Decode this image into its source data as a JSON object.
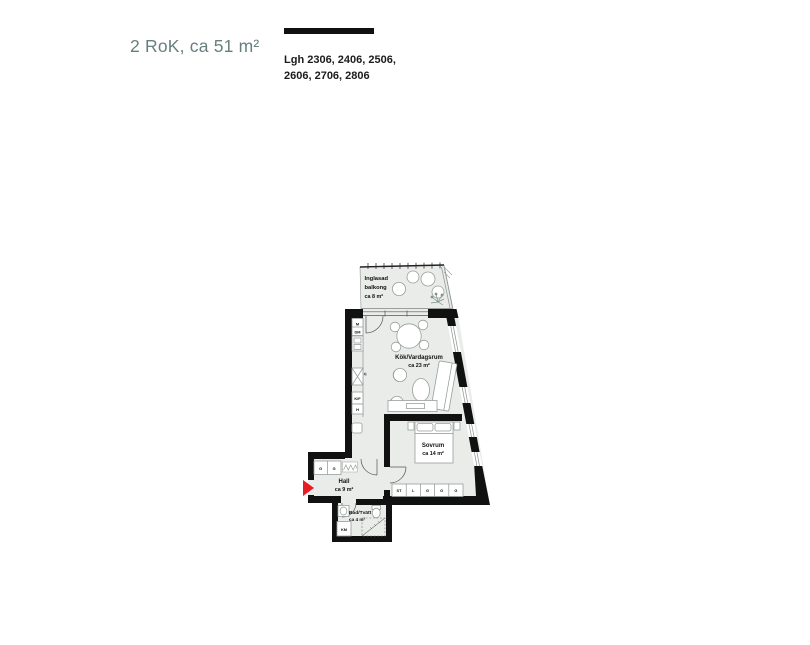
{
  "header": {
    "title": "2 RoK, ca 51 m²",
    "apartments": {
      "line1": "Lgh 2306, 2406, 2506,",
      "line2": "2606, 2706, 2806"
    }
  },
  "plan": {
    "balcony": {
      "line1": "Inglasad",
      "line2": "balkong",
      "area": "ca 8 m²"
    },
    "kitchen_living": {
      "name": "Kök/Vardagsrum",
      "area": "ca 23 m²"
    },
    "bedroom": {
      "name": "Sovrum",
      "area": "ca 14 m²"
    },
    "hall": {
      "name": "Hall",
      "area": "ca 9 m²"
    },
    "bathroom": {
      "name": "Bad/Tvätt",
      "area": "ca 4 m²"
    },
    "kitchen_labels": [
      "M",
      "DM",
      "U",
      "K/F",
      "H"
    ],
    "hall_closets": [
      "G",
      "G"
    ],
    "bedroom_closets": [
      "ST",
      "L",
      "G",
      "G",
      "G"
    ],
    "bathroom_labels": {
      "km": "KM"
    }
  },
  "colors": {
    "accent_teal": "#67807d",
    "wall_black": "#111111",
    "floor_gray": "#eaece9",
    "entry_red": "#e81c24"
  }
}
